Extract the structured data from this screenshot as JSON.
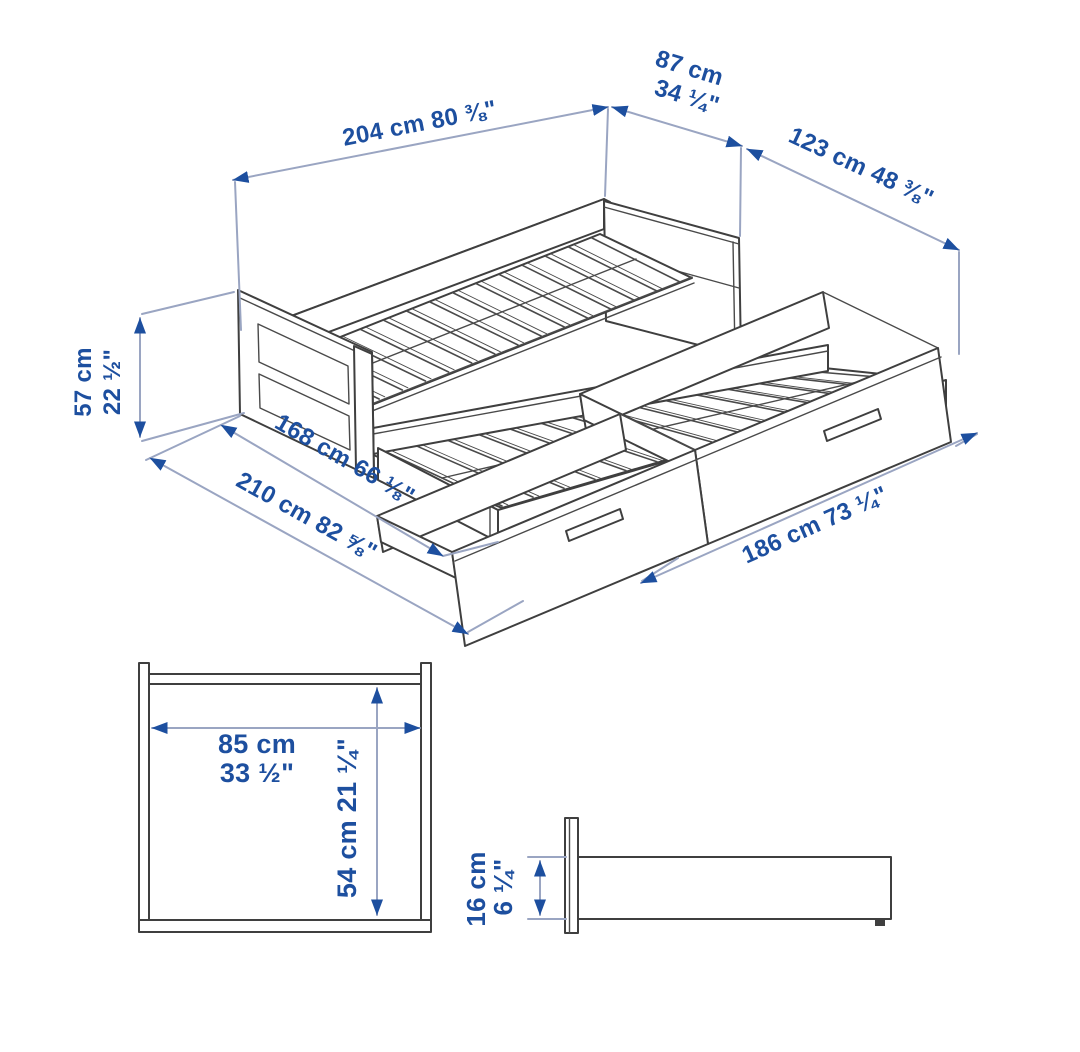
{
  "colors": {
    "dimension_text": "#1d4f9f",
    "dimension_line": "#9aa5c2",
    "drawing_line": "#3f3f3f",
    "background": "#ffffff"
  },
  "dimensions": {
    "bed_length": {
      "label": "204 cm 80 ⅜\""
    },
    "bed_width": {
      "line1": "87 cm",
      "line2": "34 ¼\""
    },
    "pullout_extension": {
      "label": "123 cm 48 ⅜\""
    },
    "bed_height": {
      "line1": "57 cm",
      "line2": "22 ½\""
    },
    "depth_extended": {
      "label": "168 cm 66 ⅛\""
    },
    "depth_total": {
      "label": "210 cm 82 ⅝\""
    },
    "drawer_span": {
      "label": "186 cm 73 ¼\""
    },
    "end_panel_width": {
      "line1": "85 cm",
      "line2": "33 ½\""
    },
    "end_panel_height": {
      "label": "54 cm 21 ¼\""
    },
    "side_rail_height": {
      "line1": "16 cm",
      "line2": "6 ¼\""
    }
  }
}
